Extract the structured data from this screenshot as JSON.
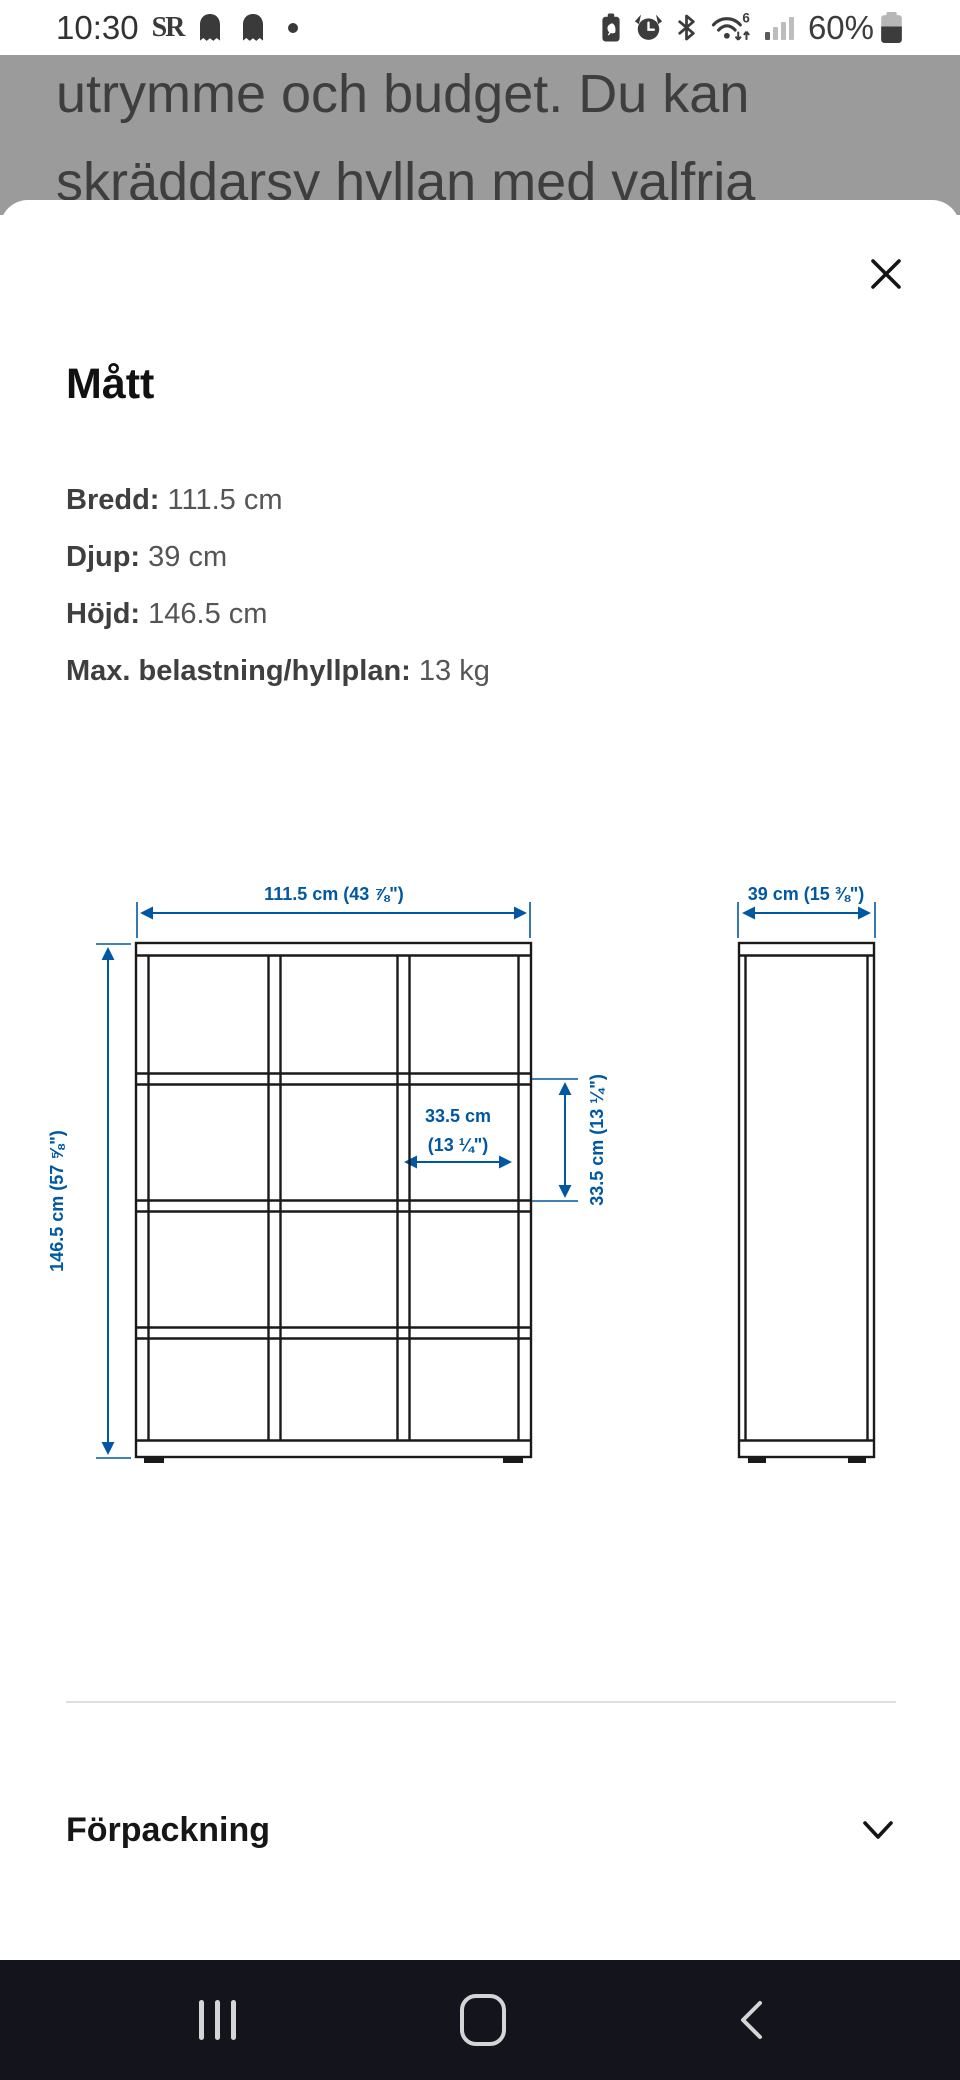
{
  "status_bar": {
    "time": "10:30",
    "sr_logo": "SR",
    "notification_icons": [
      "sr-logo",
      "snapchat-ghost",
      "snapchat-ghost",
      "notification-dot"
    ],
    "system_icons": [
      "battery-saver-icon",
      "alarm-icon",
      "bluetooth-icon",
      "wifi6-icon",
      "signal-icon",
      "battery-icon"
    ],
    "battery_percent": "60%"
  },
  "background_page": {
    "line1": "utrymme och budget. Du kan",
    "line2": "skräddarsy hyllan med valfria",
    "scrim_color": "#9b9b9b"
  },
  "modal": {
    "title": "Mått",
    "dimensions": [
      {
        "label": "Bredd:",
        "value": "111.5 cm"
      },
      {
        "label": "Djup:",
        "value": "39 cm"
      },
      {
        "label": "Höjd:",
        "value": "146.5 cm"
      },
      {
        "label": "Max. belastning/hyllplan:",
        "value": "13 kg"
      }
    ],
    "drawing": {
      "type": "technical-dimension-drawing",
      "views": [
        "front-view-shelf-3x4-grid",
        "side-view"
      ],
      "width_label": "111.5 cm (43 ⅞\")",
      "height_label": "146.5 cm (57 ⅝\")",
      "cell_width_label_line1": "33.5 cm",
      "cell_width_label_line2": "(13 ¼\")",
      "cell_height_label": "33.5 cm (13 ¼\")",
      "depth_label": "39 cm (15 ⅜\")",
      "accent_color": "#0058a3",
      "line_color": "#1a1a1a"
    },
    "sections": [
      {
        "label": "Förpackning",
        "state": "collapsed"
      }
    ]
  },
  "nav_bar": {
    "background": "#14141d",
    "buttons": [
      "recents",
      "home",
      "back"
    ]
  }
}
